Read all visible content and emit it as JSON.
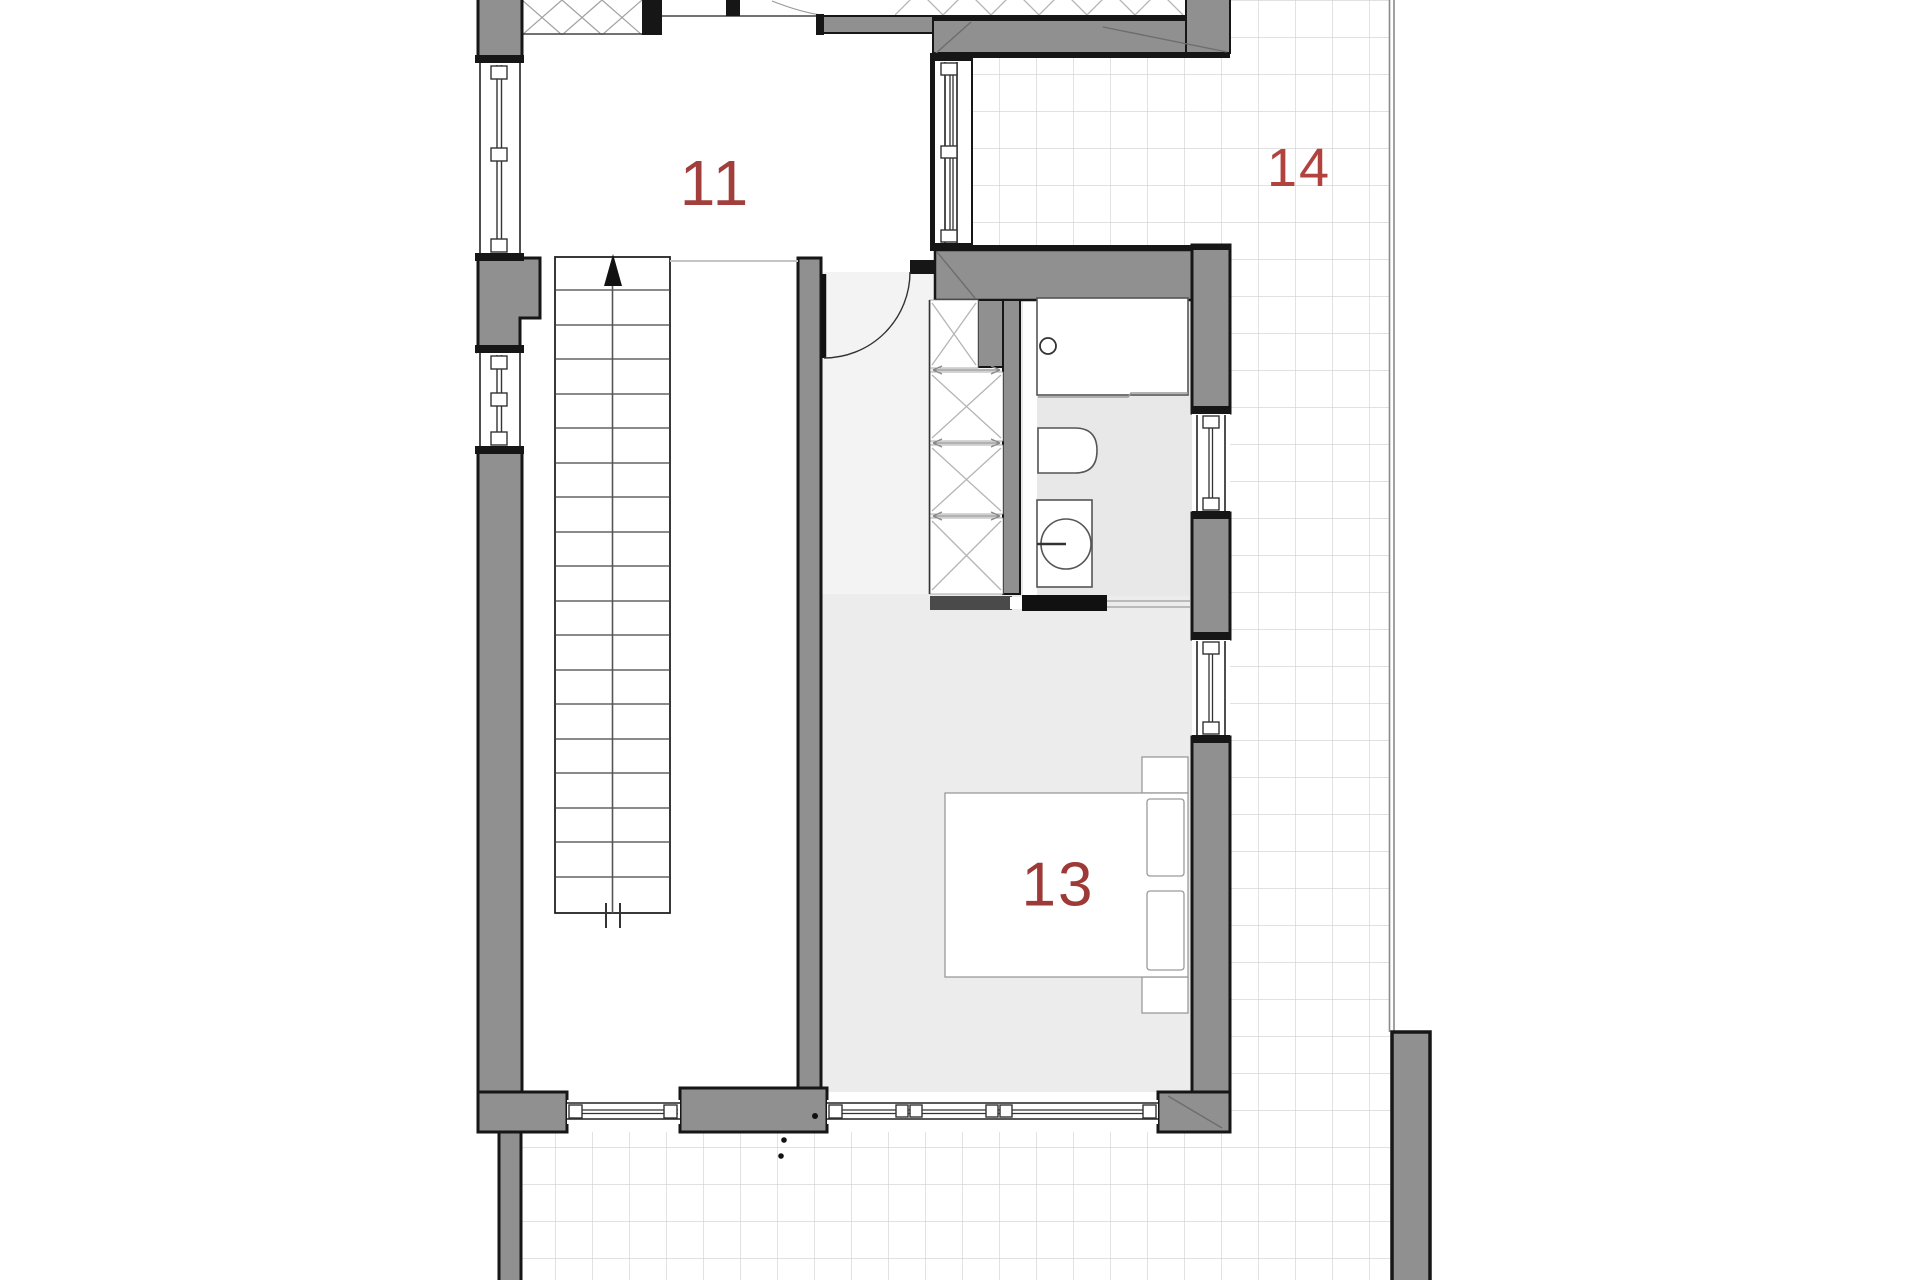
{
  "document": {
    "type": "architectural-floor-plan",
    "description": "Upper floor plan with staircase, bedroom, bathroom and tiled terraces"
  },
  "rooms": [
    {
      "id": "room-11",
      "label": "11",
      "label_color": "#a03f3c",
      "kind": "room"
    },
    {
      "id": "room-13",
      "label": "13",
      "label_color": "#9d3a37",
      "kind": "bedroom"
    },
    {
      "id": "room-14",
      "label": "14",
      "label_color": "#b2423d",
      "kind": "terrace"
    }
  ],
  "symbols": {
    "stairs_arrow": "up-direction-arrow",
    "door_swing": "quarter-circle-arc",
    "closet_cells": "x-crossed-shelving",
    "windows": "double-line-glazing-with-sash-marks"
  },
  "colors": {
    "background": "#ffffff",
    "wall_fill": "#909090",
    "wall_outline": "#161616",
    "tile_grid_line": "#cfcfcf",
    "floor_light_gray": "#ececec",
    "bathroom_floor": "#e8e8e8",
    "hallway_floor": "#f3f3f3",
    "hatch_line": "#a0a0a0",
    "terrace_edge_line": "#8a8a8a"
  }
}
